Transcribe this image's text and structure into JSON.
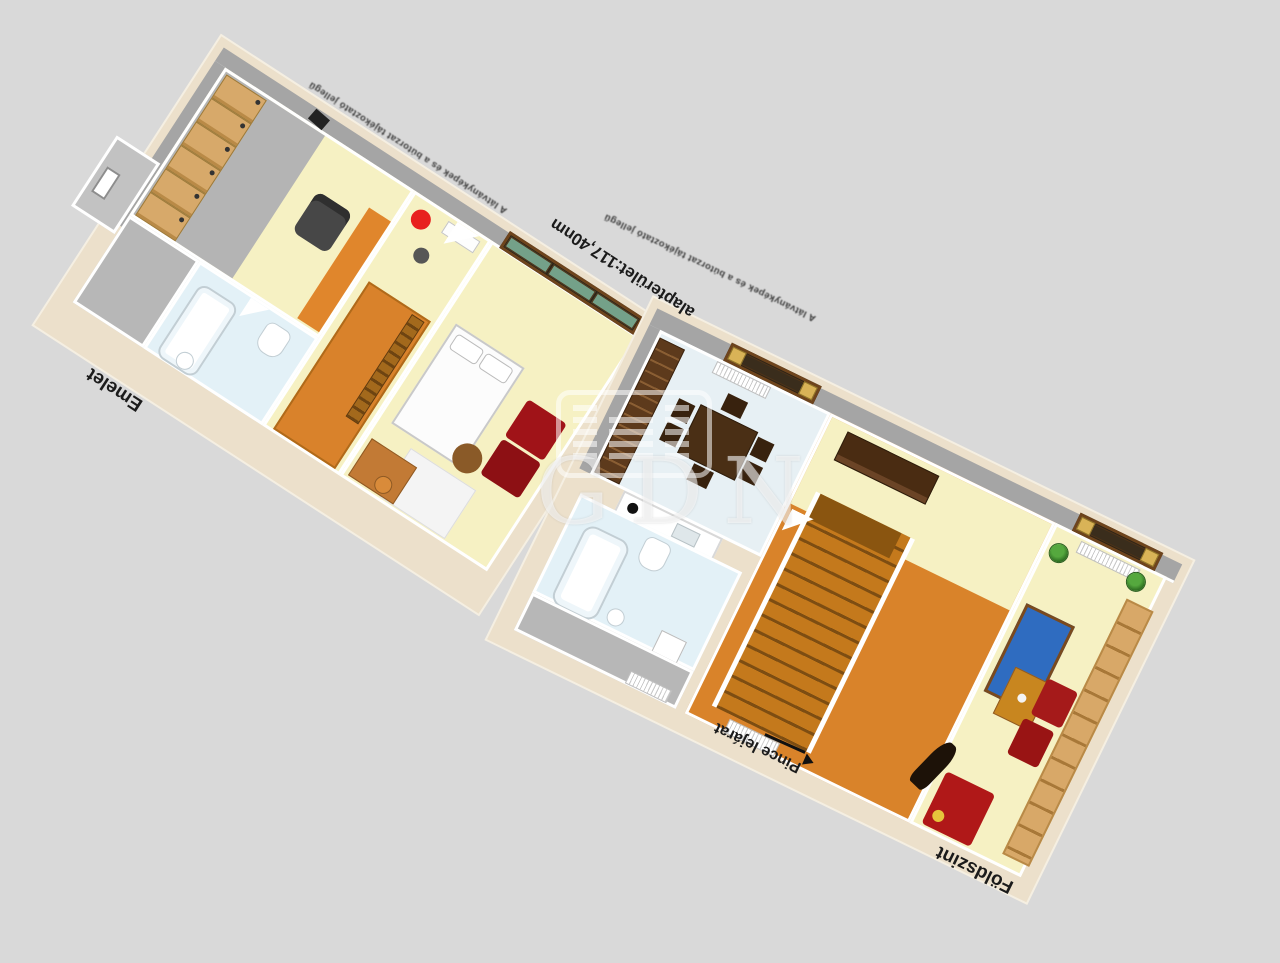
{
  "scene": {
    "type": "3d-floorplan-render",
    "background_color": "#d9d9d9"
  },
  "labels": {
    "emelet": "Emelet",
    "foldszint": "Földszint",
    "pince_lejarat": "Pince lejárat",
    "area": "alapterület:117,40nm",
    "disclaimer": "A látványképek és a bútorzat tájékoztató jellegű"
  },
  "watermark": {
    "text": "GDN",
    "logo_icon": "gdn-building-logo"
  },
  "colors": {
    "background": "#d9d9d9",
    "foundation_cream": "#ece0cb",
    "wall_white": "#ffffff",
    "wall_gray_top": "#a5a5a5",
    "floor_yellow": "#f6f1c3",
    "floor_orange": "#d9832a",
    "floor_blue_white": "#e3f1f7",
    "floor_gray": "#b7b7b7",
    "wood_light": "#d7a96a",
    "wood_dark": "#4a2f15",
    "stair_wood": "#c4791c",
    "sofa_red": "#b01818",
    "armchair_red": "#a51a1a",
    "accent_red_table": "#e8201e",
    "rug_blue": "#2f6cc0",
    "window_green": "#74a189",
    "curtain_yellow": "#d9b357",
    "plant_green": "#3e8e2e"
  }
}
